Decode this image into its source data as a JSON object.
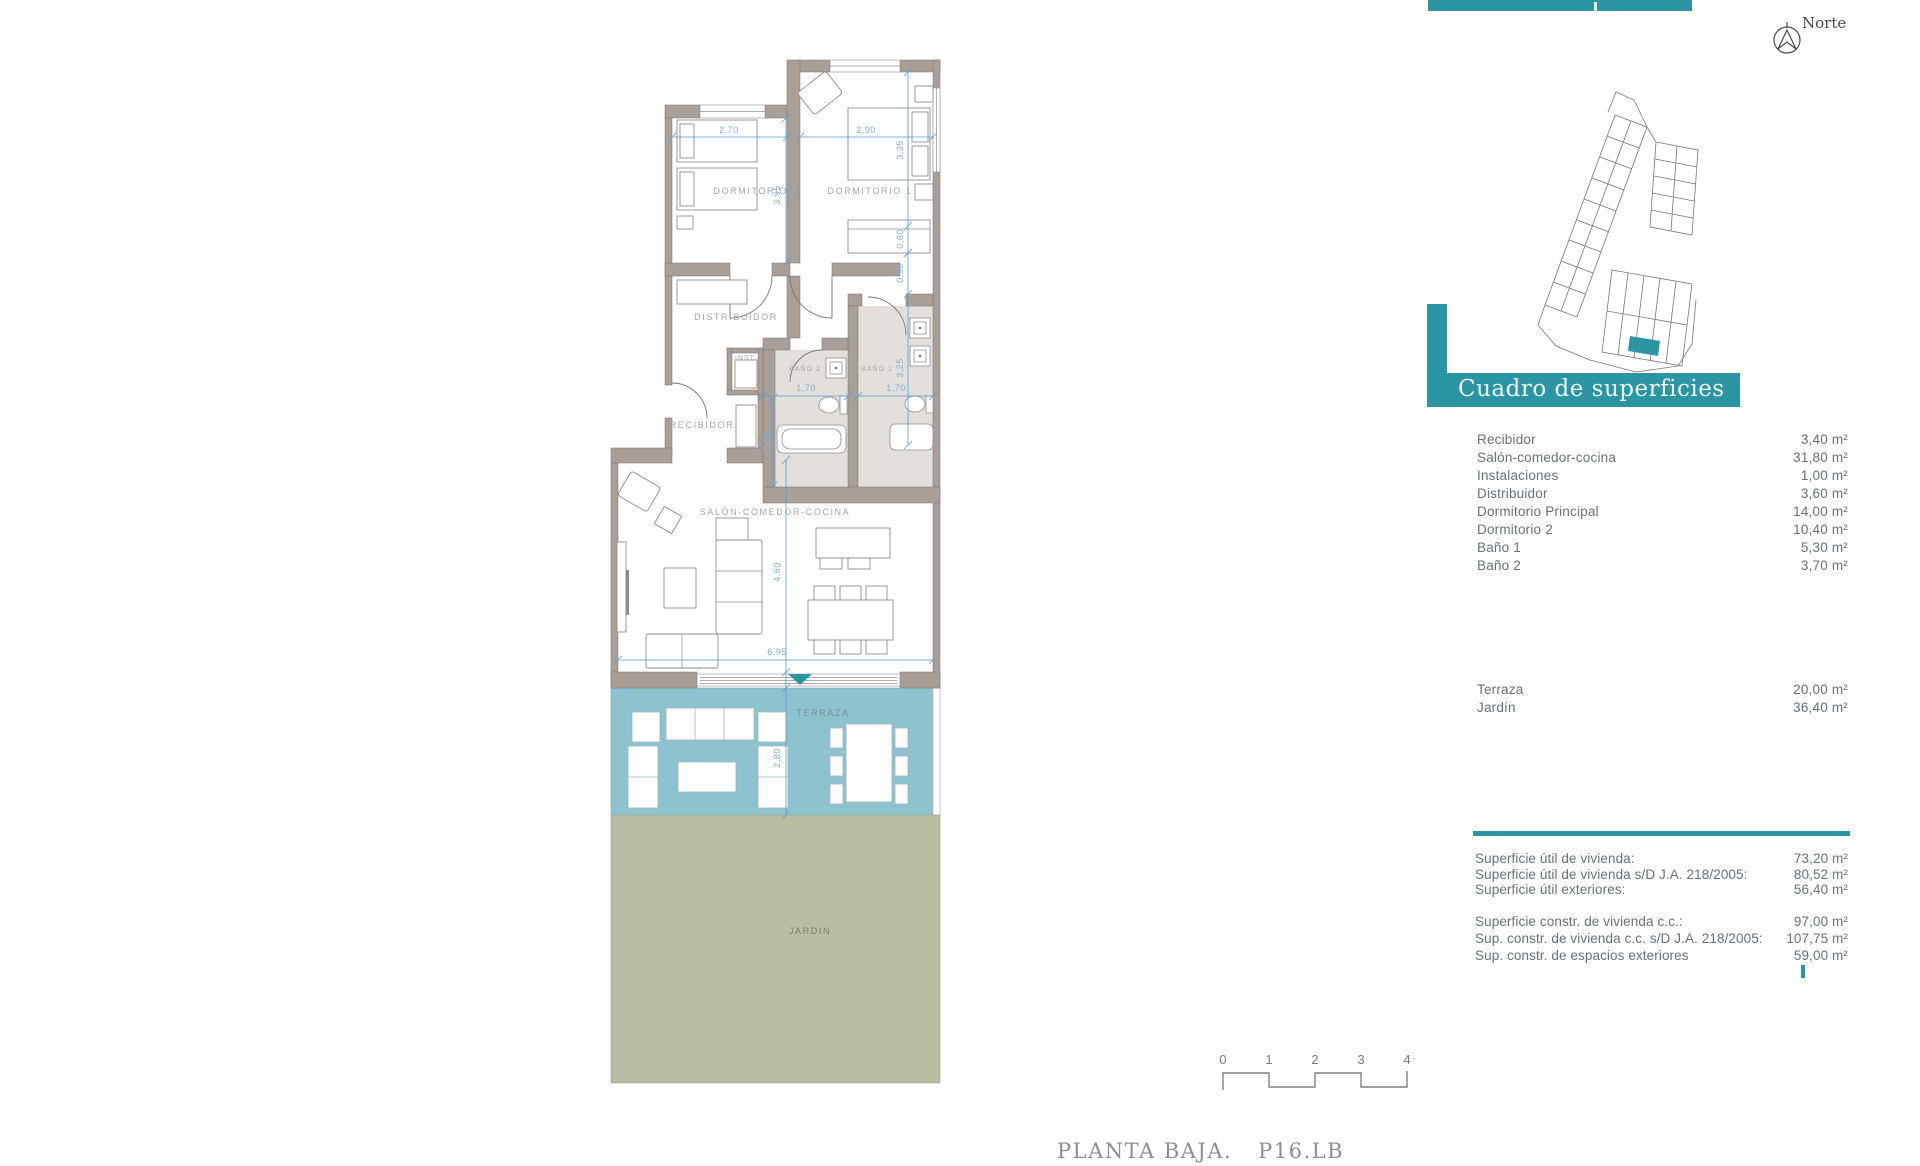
{
  "colors": {
    "accent_teal": "#2b95a4",
    "terraza_fill": "#8cc3ce",
    "jardin_fill": "#b9bda1",
    "wall_fill": "#a89f98",
    "dimension_blue": "#5b9bd5",
    "panel_text": "#68717a"
  },
  "compass": {
    "label": "Norte"
  },
  "surface_table": {
    "title": "Cuadro de superficies",
    "rows": [
      {
        "label": "Recibidor",
        "value": "3,40 m²"
      },
      {
        "label": "Salón-comedor-cocina",
        "value": "31,80 m²"
      },
      {
        "label": "Instalaciones",
        "value": "1,00 m²"
      },
      {
        "label": "Distribuidor",
        "value": "3,60 m²"
      },
      {
        "label": "Dormitorio Principal",
        "value": "14,00 m²"
      },
      {
        "label": "Dormitorio 2",
        "value": "10,40 m²"
      },
      {
        "label": "Baño 1",
        "value": "5,30 m²"
      },
      {
        "label": "Baño 2",
        "value": "3,70 m²"
      }
    ],
    "exterior_rows": [
      {
        "label": "Terraza",
        "value": "20,00 m²"
      },
      {
        "label": "Jardín",
        "value": "36,40 m²"
      }
    ],
    "summary_rows": [
      {
        "label": "Superficie útil de vivienda:",
        "value": "73,20 m²"
      },
      {
        "label": "Superficie útil de vivienda s/D J.A. 218/2005:",
        "value": "80,52 m²"
      },
      {
        "label": "Superficie útil exteriores:",
        "value": "56,40 m²"
      },
      {
        "label": "Superficie constr. de vivienda c.c.:",
        "value": "97,00 m²"
      },
      {
        "label": "Sup. constr. de vivienda c.c. s/D J.A. 218/2005:",
        "value": "107,75 m²"
      },
      {
        "label": "Sup. constr. de espacios exteriores",
        "value": "59,00 m²"
      }
    ]
  },
  "plan": {
    "rooms": {
      "dorm2": "DORMITORIO 2",
      "dorm1": "DORMITORIO 1",
      "distribuidor": "DISTRIBUIDOR",
      "inst": "INST.",
      "bano2": "BAÑO 2",
      "bano1": "BAÑO 1",
      "recibidor": "RECIBIDOR",
      "salon": "SALÓN-COMEDOR-COCINA",
      "terraza": "TERRAZA",
      "jardin": "JARDIN"
    },
    "dims": {
      "dorm2_width": "2,70",
      "dorm1_width": "2,90",
      "dorm1_depth": "3,35",
      "dorm2_depth": "3,95",
      "wardrobe_depth": "0,60",
      "passage_width": "0,90",
      "bano2_width": "1,70",
      "bano1_width": "1,70",
      "bano2_depth": "2,20",
      "bano1_depth": "3,25",
      "salon_depth": "4,60",
      "salon_width": "6,95",
      "terraza_depth": "2,80"
    }
  },
  "scale_bar": {
    "ticks": [
      "0",
      "1",
      "2",
      "3",
      "4"
    ]
  },
  "sheet_title": {
    "name": "PLANTA BAJA.",
    "code": "P16.LB"
  }
}
